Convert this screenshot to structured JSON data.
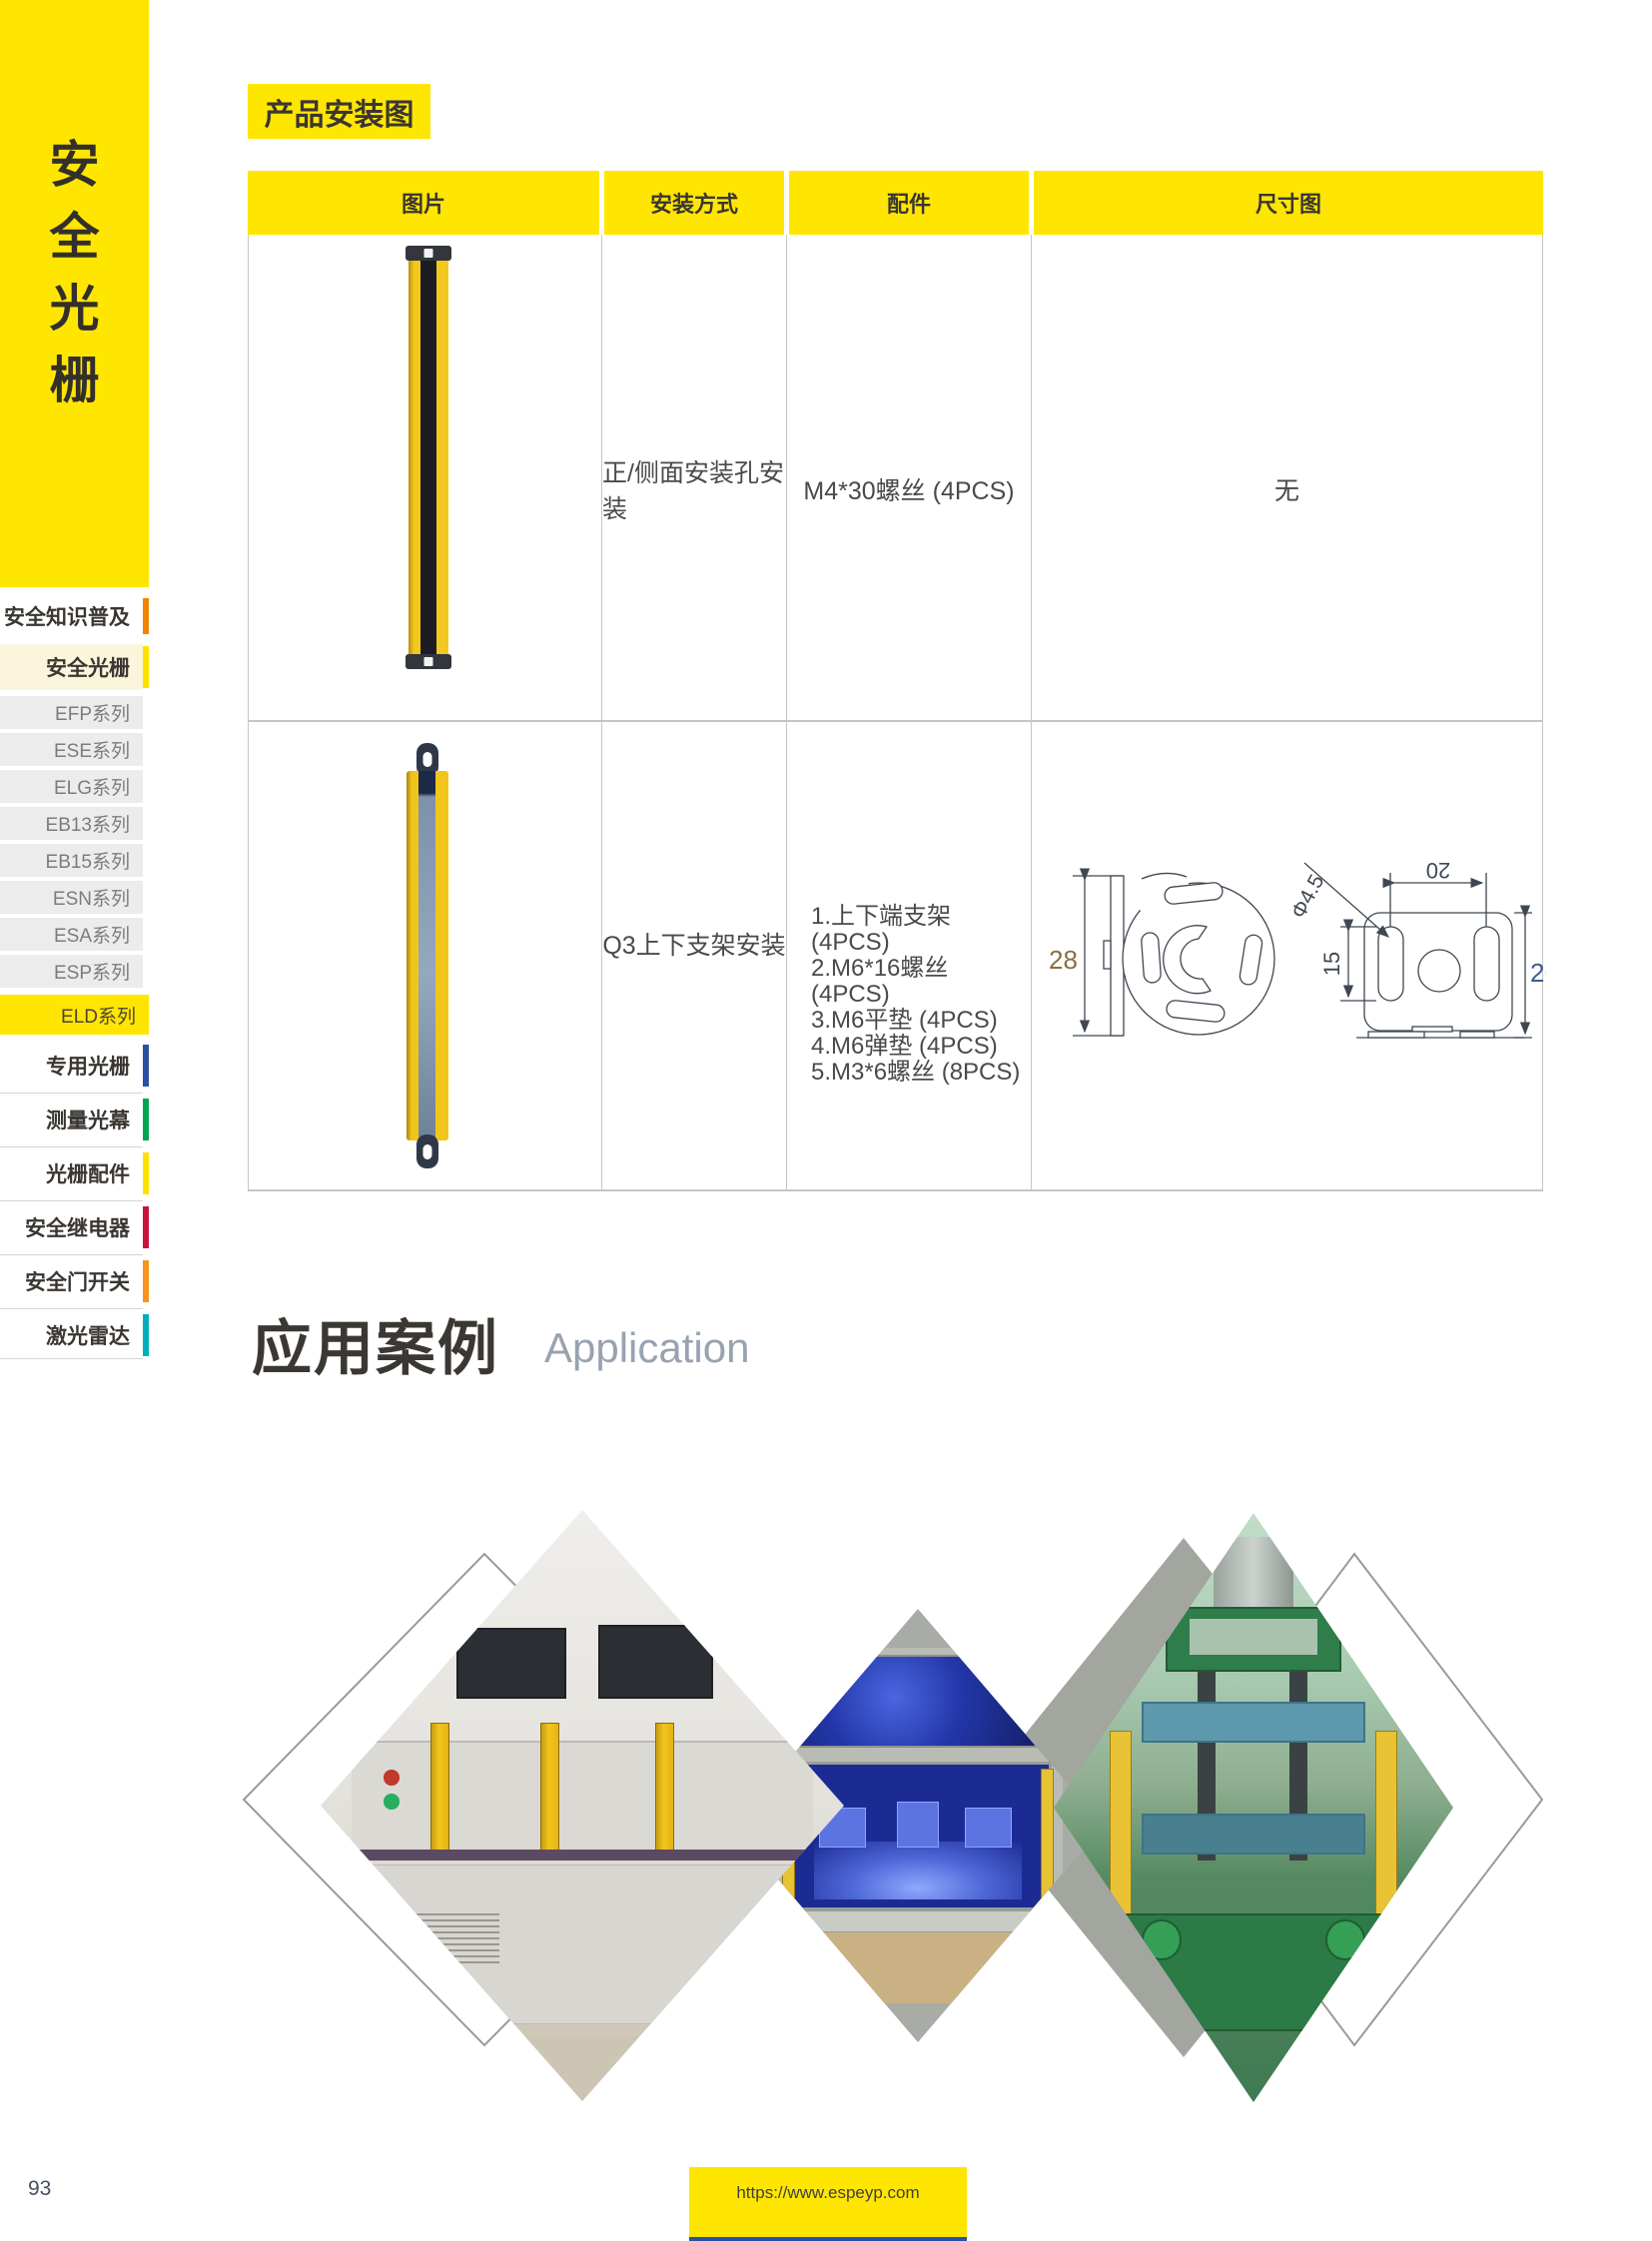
{
  "sidebar": {
    "brand": "安全光栅",
    "brand_chars": [
      "安",
      "全",
      "光",
      "栅"
    ],
    "items": [
      {
        "label": "安全知识普及",
        "bar_color": "#F08300"
      },
      {
        "label": "安全光栅",
        "bar_color": "#FFE100"
      },
      {
        "label": "EFP系列"
      },
      {
        "label": "ESE系列"
      },
      {
        "label": "ELG系列"
      },
      {
        "label": "EB13系列"
      },
      {
        "label": "EB15系列"
      },
      {
        "label": "ESN系列"
      },
      {
        "label": "ESA系列"
      },
      {
        "label": "ESP系列"
      },
      {
        "label": "ELD系列"
      },
      {
        "label": "专用光栅",
        "bar_color": "#2B50A1"
      },
      {
        "label": "测量光幕",
        "bar_color": "#00A550"
      },
      {
        "label": "光栅配件",
        "bar_color": "#FFE100"
      },
      {
        "label": "安全继电器",
        "bar_color": "#C8143C"
      },
      {
        "label": "安全门开关",
        "bar_color": "#F7941E"
      },
      {
        "label": "激光雷达",
        "bar_color": "#00AEBB"
      }
    ]
  },
  "header": {
    "title": "产品安装图"
  },
  "install_table": {
    "headers": [
      "图片",
      "安装方式",
      "配件",
      "尺寸图"
    ],
    "rows": [
      {
        "method": "正/侧面安装孔安装",
        "parts": [
          "M4*30螺丝 (4PCS)"
        ],
        "dimension_note": "无"
      },
      {
        "method": "Q3上下支架安装",
        "parts": [
          "1.上下端支架 (4PCS)",
          "2.M6*16螺丝 (4PCS)",
          "3.M6平垫 (4PCS)",
          "4.M6弹垫 (4PCS)",
          "5.M3*6螺丝 (8PCS)"
        ],
        "dimensions": {
          "bracket_height": "28",
          "slot_length": "15",
          "hole_spacing": "20",
          "plate_height": "26",
          "hole_diameter": "Φ4.5"
        }
      }
    ]
  },
  "application": {
    "title_cn": "应用案例",
    "title_en": "Application"
  },
  "footer": {
    "page_number": "93",
    "url": "https://www.espeyp.com"
  },
  "colors": {
    "brand_yellow": "#FFE600",
    "dim_28": "#8A6D45",
    "dim_26": "#3D5C94"
  }
}
